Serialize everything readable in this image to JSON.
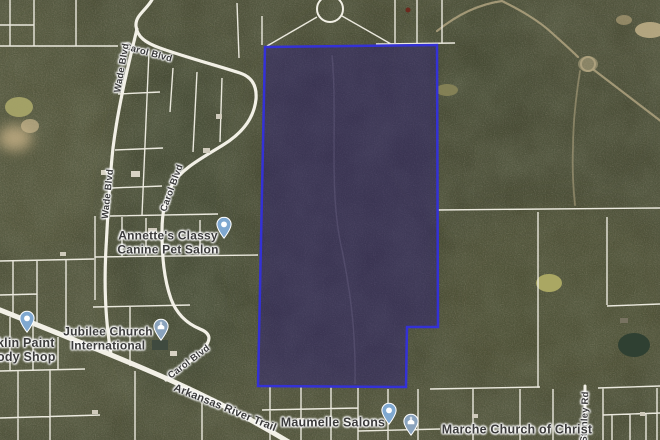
{
  "map": {
    "view": "satellite",
    "parcel": {
      "outline_color": "#3431d6",
      "fill_color": "#2b1a78",
      "fill_opacity": "0.45"
    },
    "road_labels": {
      "carol_top": "Carol Blvd",
      "wade_top": "Wade Blvd",
      "wade_bottom": "Wade Blvd",
      "carol_mid": "Carol Blvd",
      "carol_low": "Carol Blvd",
      "arkansas_river_trail": "Arkansas River Trail",
      "stanley": "Stanley Rd"
    },
    "places": {
      "annettes": {
        "line1": "Annette's Classy",
        "line2": "Canine Pet Salon",
        "pin_color": "#7fa8d0"
      },
      "jubilee": {
        "line1": "Jubilee Church",
        "line2": "International",
        "pin_color": "#8aa3bd"
      },
      "paint_shop": {
        "line1": "klin Paint",
        "line2": "ody Shop",
        "pin_color": "#7fa8d0"
      },
      "maumelle": {
        "name": "Maumelle Salons",
        "pin_color": "#7fa8d0"
      },
      "marche": {
        "name": "Marche Church of Christ",
        "pin_color": "#8aa3bd"
      }
    }
  }
}
